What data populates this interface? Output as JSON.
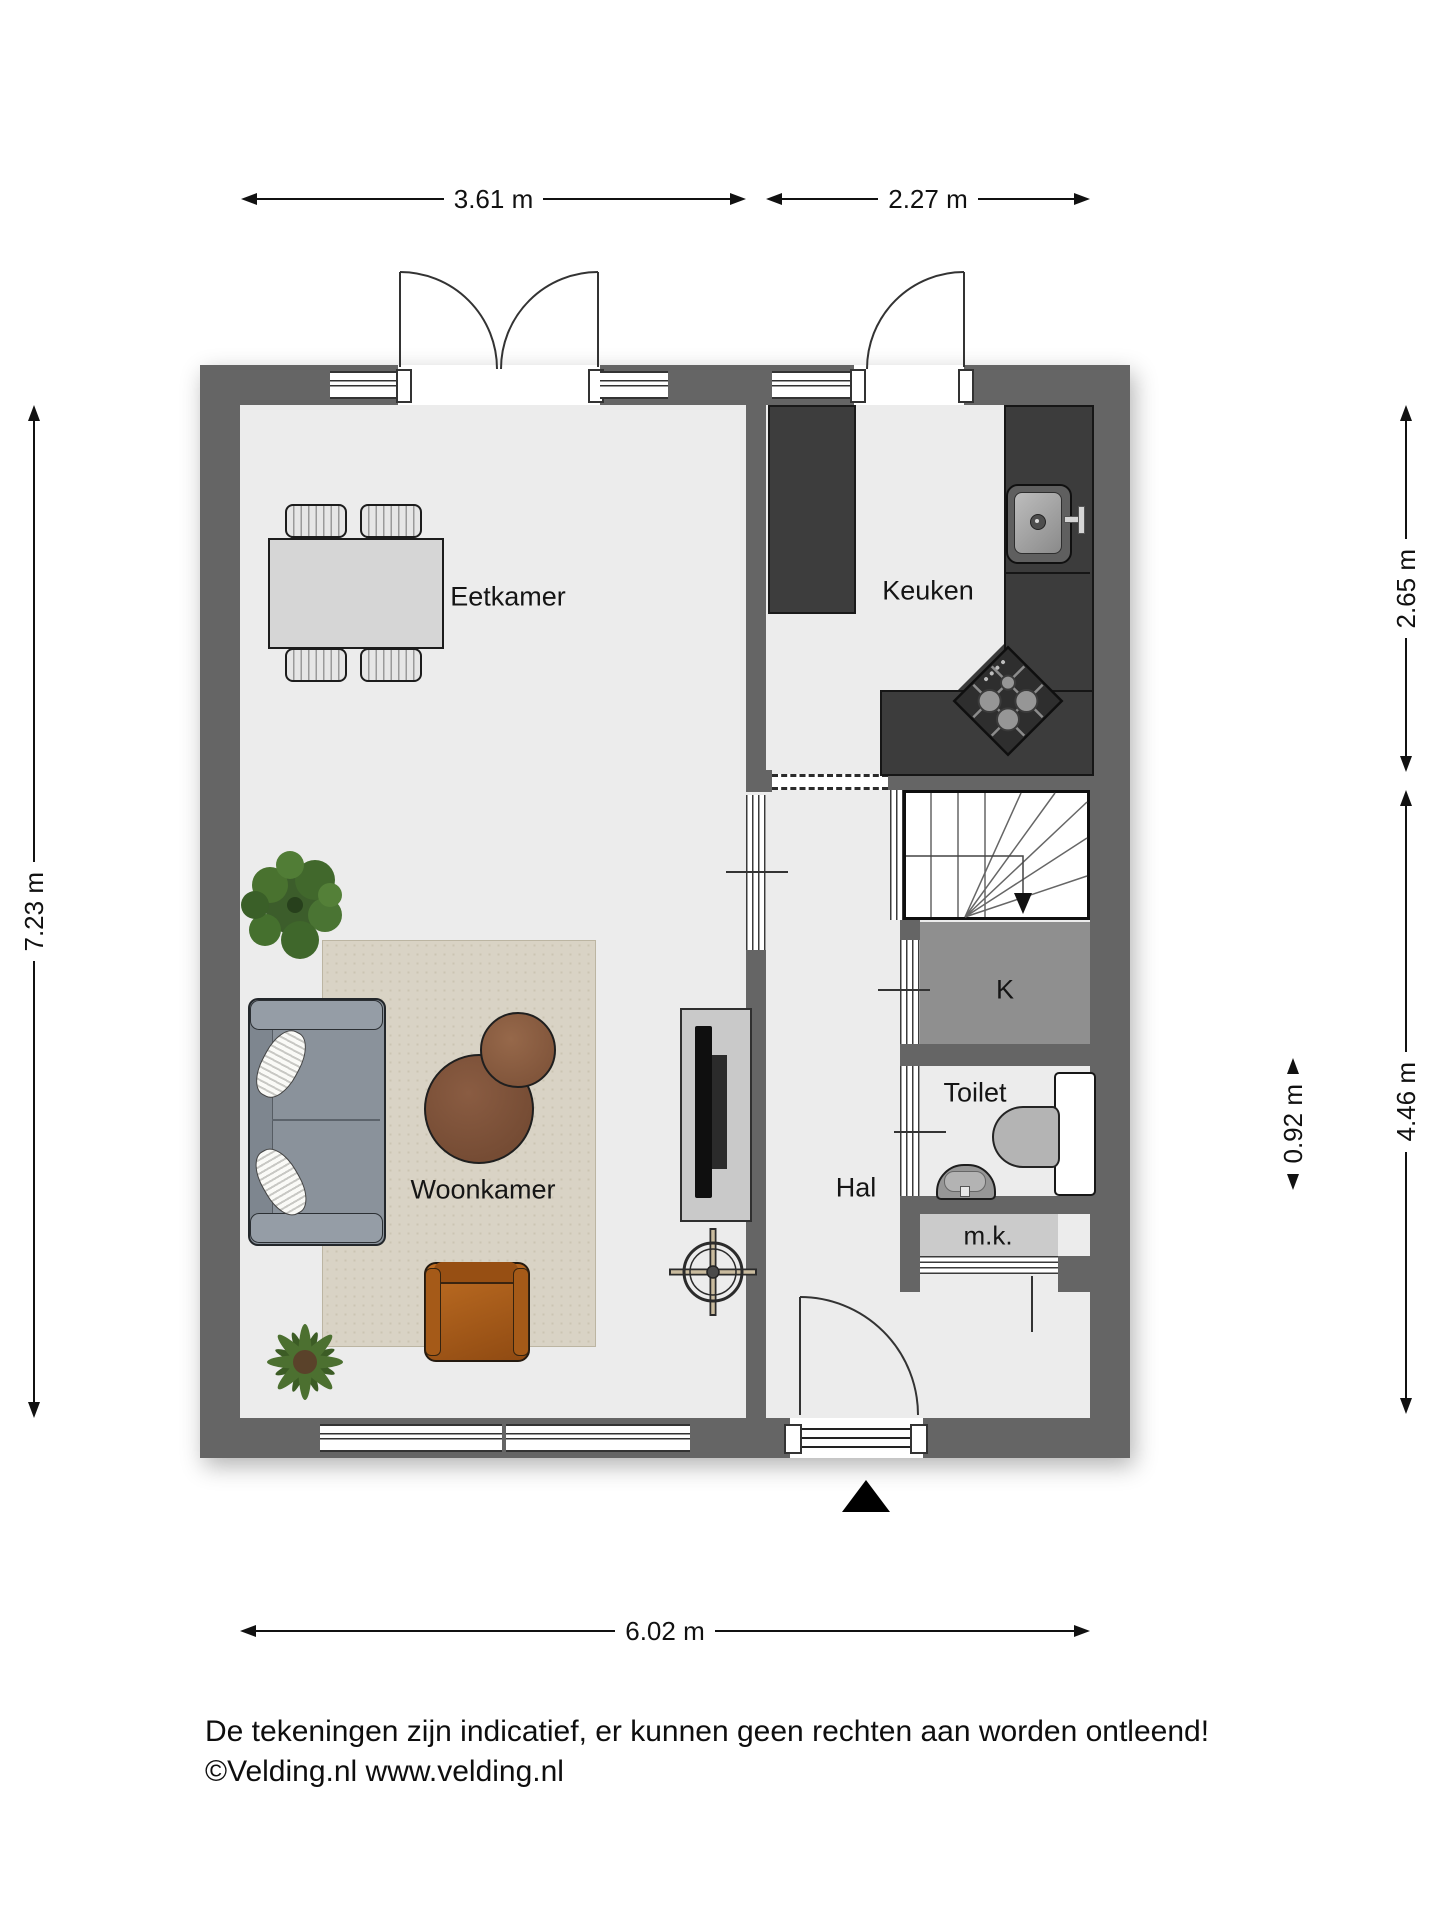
{
  "title": "Begane grond plattegrond",
  "rooms": {
    "eetkamer": {
      "label": "Eetkamer"
    },
    "keuken": {
      "label": "Keuken"
    },
    "woonkamer": {
      "label": "Woonkamer"
    },
    "hal": {
      "label": "Hal"
    },
    "toilet": {
      "label": "Toilet"
    },
    "kast": {
      "label": "K"
    },
    "meterkast": {
      "label": "m.k."
    }
  },
  "dimensions": {
    "top_left": "3.61 m",
    "top_right": "2.27 m",
    "left": "7.23 m",
    "right_upper": "2.65 m",
    "right_lower": "4.46 m",
    "right_inner": "0.92 m",
    "bottom": "6.02 m"
  },
  "footer": {
    "line1": "De tekeningen zijn indicatief, er kunnen geen rechten aan worden ontleend!",
    "line2": "©Velding.nl www.velding.nl"
  },
  "colors": {
    "wall": "#656565",
    "floor": "#ececec",
    "counter": "#3c3c3c",
    "closet_fill": "#8f8f8f",
    "meterkast_fill": "#cbcbcb",
    "rug": "#d9d3c5",
    "sofa": "#8a929b",
    "wood_table": "#7a5138",
    "armchair": "#b2671f",
    "plant": "#4a7233"
  },
  "icons": {
    "furniture": [
      "dining-table",
      "dining-chair",
      "area-rug",
      "sofa",
      "pillow",
      "coffee-table",
      "armchair",
      "plant",
      "tv",
      "ceiling-light-symbol",
      "refrigerator",
      "kitchen-counter",
      "kitchen-sink",
      "gas-hob",
      "stairs",
      "stairs-direction-arrow",
      "toilet-bowl",
      "toilet-cistern",
      "hand-basin",
      "door-swing",
      "window",
      "north-arrow"
    ]
  }
}
